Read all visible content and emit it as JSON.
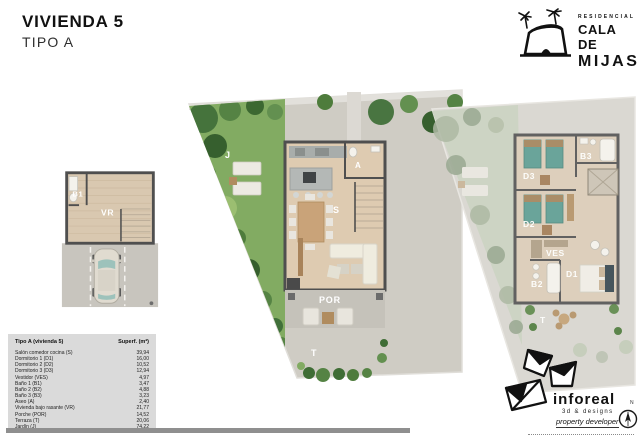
{
  "header": {
    "title": "VIVIENDA 5",
    "subtitle": "TIPO A"
  },
  "brand": {
    "residencial": "RESIDENCIAL",
    "name_line1": "CALA DE",
    "name_line2": "MIJAS"
  },
  "plan_labels": {
    "basement": {
      "b1": "B1",
      "vr": "VR"
    },
    "ground": {
      "j": "J",
      "a": "A",
      "s": "S",
      "por": "POR",
      "t": "T"
    },
    "first": {
      "d3": "D3",
      "b3": "B3",
      "d2": "D2",
      "ves": "VES",
      "b2": "B2",
      "d1": "D1",
      "t": "T"
    }
  },
  "table": {
    "col1_header": "Tipo A (vivienda 5)",
    "col2_header": "Superf. (m²)",
    "rows": [
      {
        "label": "Salón comedor cocina (S)",
        "value": "39,94"
      },
      {
        "label": "Dormitorio 1 (D1)",
        "value": "16,00"
      },
      {
        "label": "Dormitorio 2 (D2)",
        "value": "10,52"
      },
      {
        "label": "Dormitorio 3 (D3)",
        "value": "12,94"
      },
      {
        "label": "Vestidor (VES)",
        "value": "4,97"
      },
      {
        "label": "Baño 1 (B1)",
        "value": "3,47"
      },
      {
        "label": "Baño 2 (B2)",
        "value": "4,88"
      },
      {
        "label": "Baño 3 (B3)",
        "value": "3,23"
      },
      {
        "label": "Aseo (A)",
        "value": "2,40"
      },
      {
        "label": "Vivienda bajo rasante (VR)",
        "value": "21,77"
      },
      {
        "label": "Porche (POR)",
        "value": "14,52"
      },
      {
        "label": "Terraza (T)",
        "value": "20,06"
      },
      {
        "label": "Jardín (J)",
        "value": "74,22"
      }
    ]
  },
  "developer": {
    "brand": "inforeal",
    "tagline1": "3d & designs",
    "tagline2": "property developer",
    "north_label": "N"
  },
  "colors": {
    "garden_green": "#7fa75f",
    "tree_dark": "#3f6d35",
    "paving": "#cfccc4",
    "wood_floor": "#dccab1",
    "wall": "#4f4f4f",
    "bed_teal": "#6aa49a",
    "table_bg": "#dadada",
    "footer_bar": "#8f8f8f",
    "ink": "#1a1a1a"
  }
}
